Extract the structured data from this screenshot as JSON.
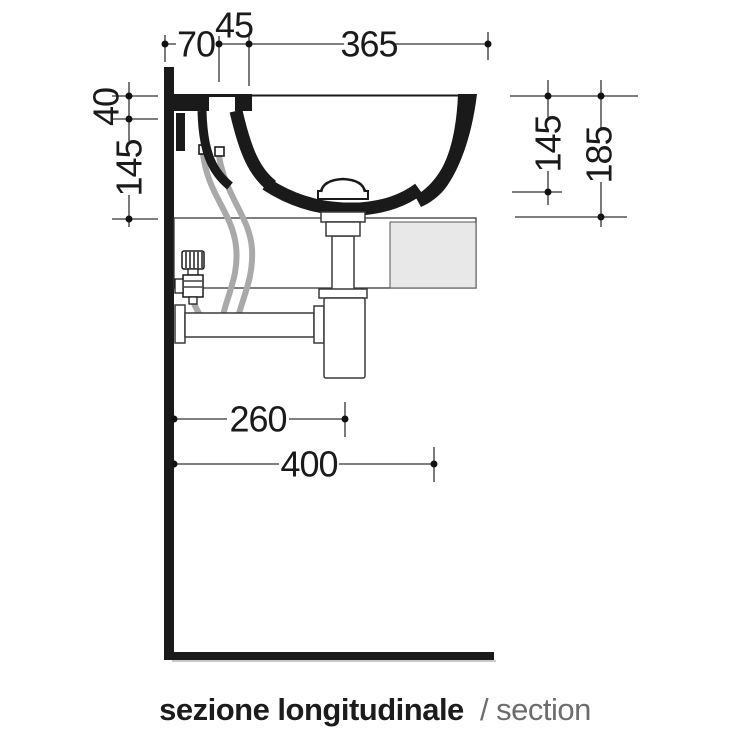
{
  "caption": {
    "italian": "sezione longitudinale",
    "english": "/ section"
  },
  "dimensions": {
    "top": [
      {
        "label": "70"
      },
      {
        "label": "45"
      },
      {
        "label": "365"
      }
    ],
    "left": [
      {
        "label": "40"
      },
      {
        "label": "145"
      }
    ],
    "right": [
      {
        "label": "145"
      },
      {
        "label": "185"
      }
    ],
    "bottom": [
      {
        "label": "260"
      },
      {
        "label": "400"
      }
    ]
  },
  "colors": {
    "line": "#1a1a1a",
    "hose": "#a9a9a9",
    "panel": "#e8e8e8"
  }
}
